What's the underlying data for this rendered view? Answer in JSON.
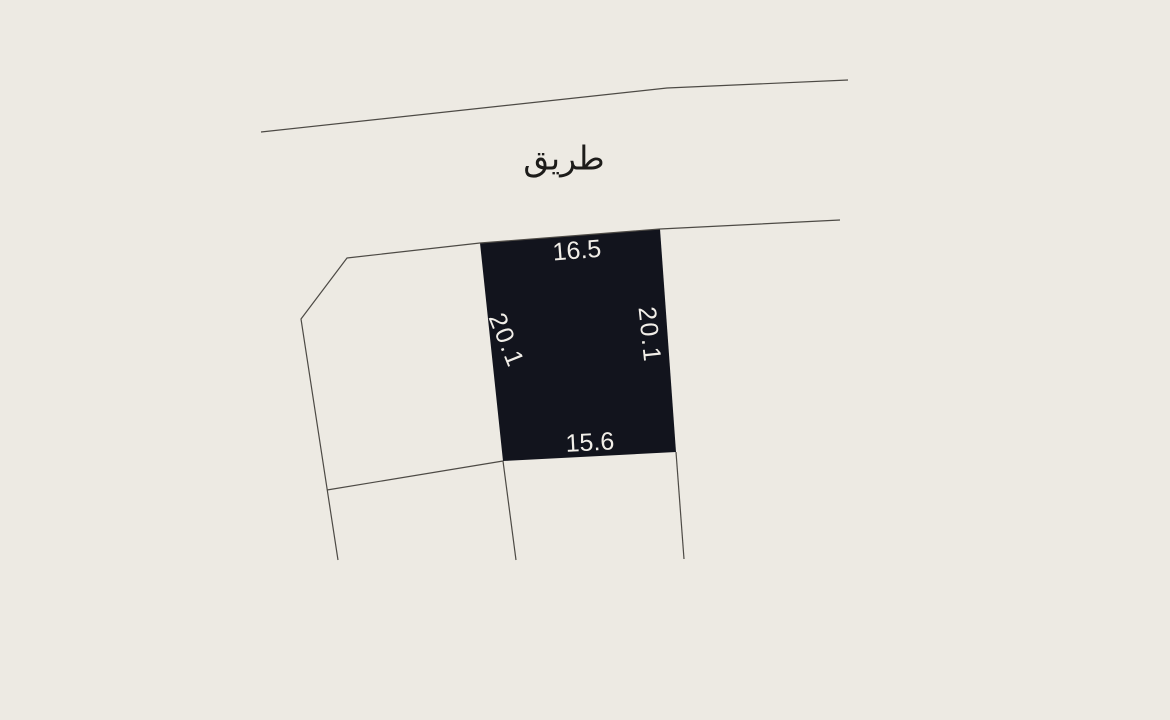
{
  "colors": {
    "background": "#edeae3",
    "parcel_fill": "#12141d",
    "boundary_line": "#4d4a45",
    "dimension_text": "#f1eee8",
    "road_text": "#1d1c1a"
  },
  "road": {
    "label": "طريق"
  },
  "parcel": {
    "dimensions": {
      "top": "16.5",
      "right": "20.1",
      "bottom": "15.6",
      "left": "20.1"
    }
  }
}
